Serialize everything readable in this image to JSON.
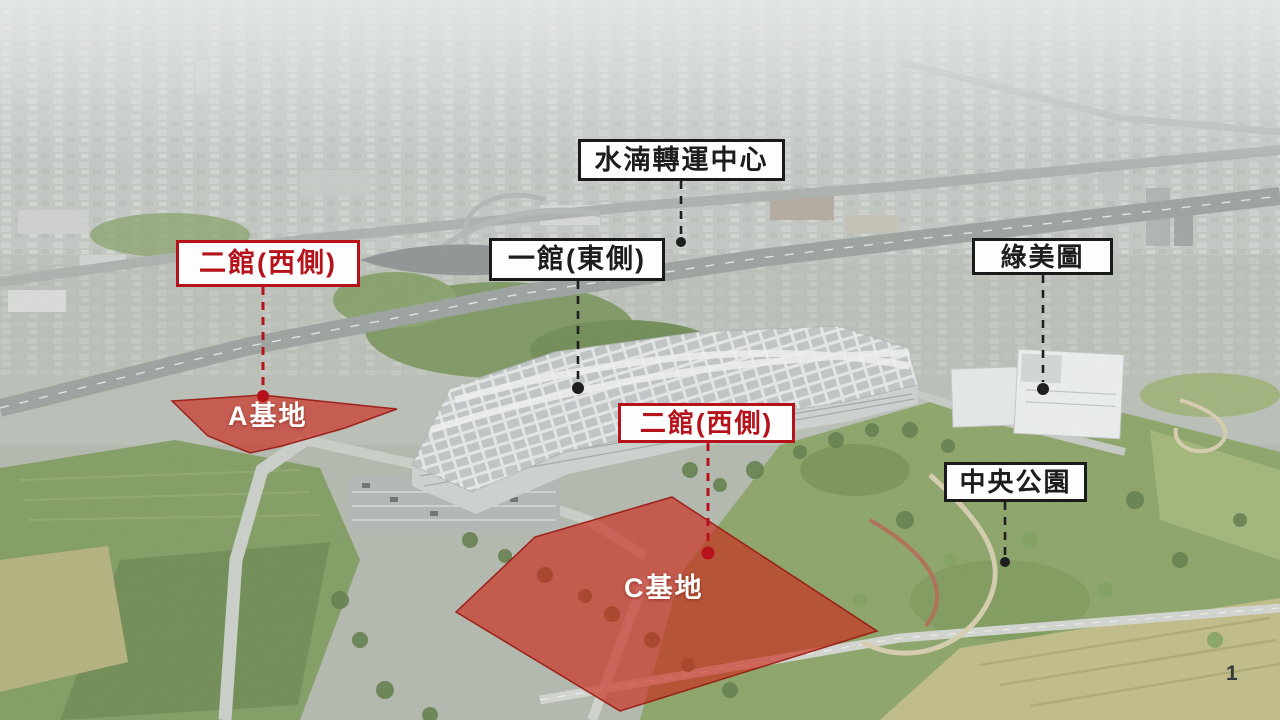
{
  "labels": {
    "shuinan": {
      "text": "水湳轉運中心"
    },
    "hall2_west_upper": {
      "text": "二館(西側)"
    },
    "hall1_east": {
      "text": "一館(東側)"
    },
    "green_museum": {
      "text": "綠美圖"
    },
    "hall2_west_lower": {
      "text": "二館(西側)"
    },
    "central_park": {
      "text": "中央公園"
    }
  },
  "sites": {
    "a": {
      "label": "A基地"
    },
    "c": {
      "label": "C基地"
    }
  },
  "page_number": "1",
  "colors": {
    "red_accent": "#b5121b",
    "black_accent": "#1a1a1a",
    "site_overlay_fill": "#cd2418"
  }
}
